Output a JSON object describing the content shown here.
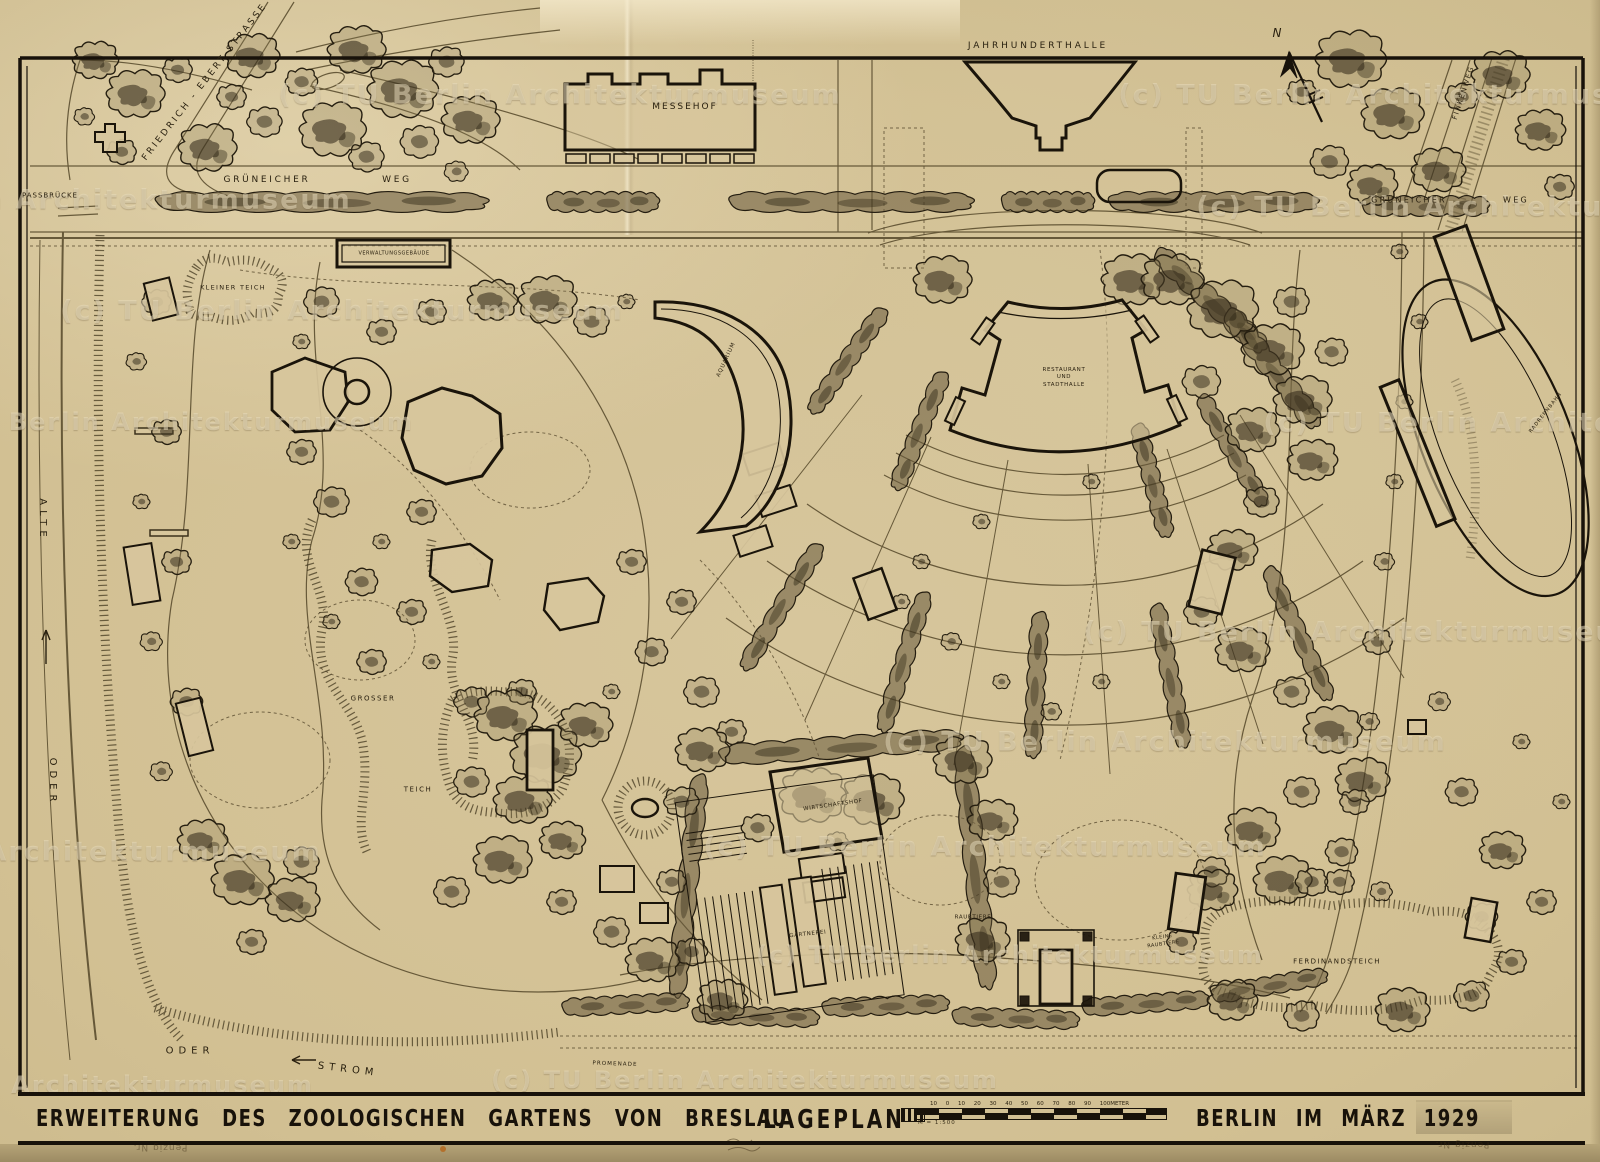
{
  "map": {
    "streets": {
      "grueneicher_left": "GRÜNEICHER",
      "weg_left": "WEG",
      "grueneicher_right": "GRÜNEICHER",
      "weg_right": "WEG",
      "friedrich_ebert": "FRIEDRICH - EBERT  STRASSE",
      "passbruecke": "PASSBRÜCKE",
      "finkenweg": "FINKENWEG",
      "promenade": "PROMENADE"
    },
    "water": {
      "alte": "ALTE",
      "oder_upper": "ODER",
      "oder_lower": "ODER",
      "strom": "STROM",
      "kleiner_teich": "KLEINER  TEICH",
      "grosser": "GROSSER",
      "teich": "TEICH",
      "ferdinandsteich": "FERDINANDSTEICH"
    },
    "buildings": {
      "messehof": "MESSEHOF",
      "jahrhunderthalle": "JAHRHUNDERTHALLE",
      "verwaltungsgebaeude": "VERWALTUNGSGEBÄUDE",
      "restaurant_line1": "RESTAURANT",
      "restaurant_line2": "UND",
      "restaurant_line3": "STADTHALLE",
      "aquarium": "AQUARIUM",
      "wirtschaftshof": "WIRTSCHAFTSHOF",
      "gaertnerei": "GÄRTNEREI",
      "raubtiere": "RAUBTIERE",
      "kleine_raubtiere": "KLEINE RAUBTIERE",
      "radrennbahn": "RADRENNBAHN"
    },
    "compass_north": "N"
  },
  "title_bar": {
    "title": "ERWEITERUNG  DES  ZOOLOGISCHEN  GARTENS  VON  BRESLAU",
    "plan_type": "LAGEPLAN",
    "place_date": "BERLIN  IM  MÄRZ  1929",
    "scale_ticks": "10 0 10 20 30 40 50 60 70 80 90 100METER",
    "scale_note": "M = 1:500"
  },
  "watermark": {
    "text": "(c) TU Berlin Architekturmuseum"
  },
  "stamps": {
    "penzig_left": "Penzig Nr.",
    "penzig_right": "Penzig Nr."
  }
}
